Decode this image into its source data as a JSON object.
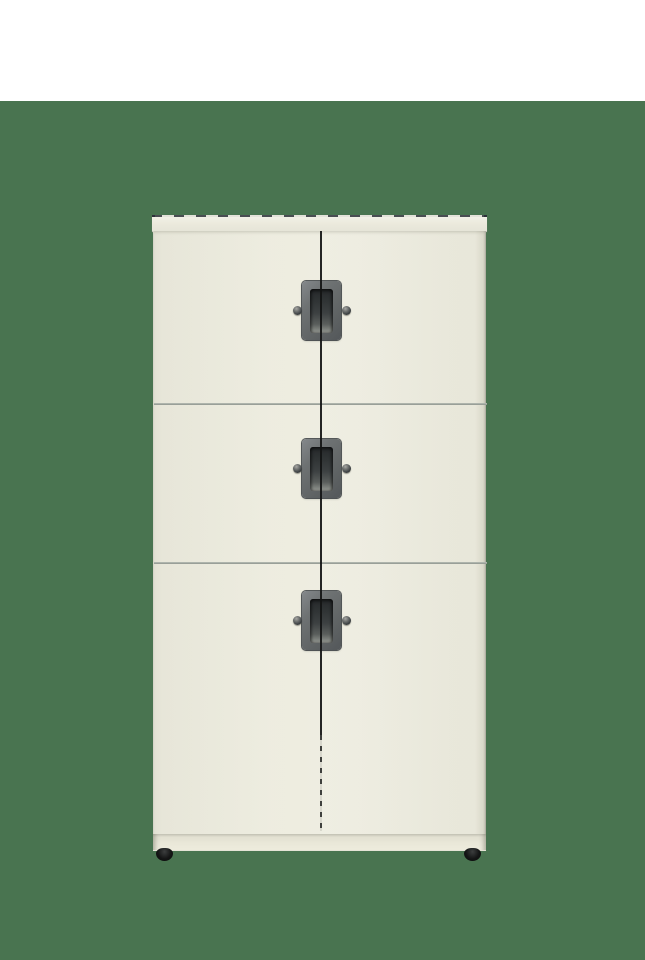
{
  "scene": {
    "type": "product-render",
    "object": "six-door locker storage cabinet, front view",
    "background_top": "#FFFFFF",
    "background": "#497450"
  },
  "theme": {
    "bg_white": "#FFFFFF",
    "bg_green": "#497450",
    "door_cream": "#EDECDF",
    "door_cream_dark": "#E7E6D8",
    "door_cream_light": "#EFEEE2",
    "top_edge_dark": "#2C3138",
    "edge_line": "#C6C6BB",
    "divider_gray": "#8F958E",
    "gap_dark": "#141616",
    "handle_frame": "#6E7273",
    "handle_frame_edge": "#3A3E42",
    "handle_recess_dark": "#26292B",
    "handle_recess_light": "#9A9D97",
    "lock_gray": "#3A3E40",
    "plinth_cream": "#E9E7D8",
    "plinth_shadow": "#C2C1B3",
    "foot_black": "#141515"
  },
  "cabinet": {
    "material_color": "#EDECDF",
    "rows": [
      {
        "id": "top",
        "label": "top compartment",
        "doors": 2,
        "handle": "recessed pull",
        "locks": 2
      },
      {
        "id": "middle",
        "label": "middle compartment",
        "doors": 2,
        "handle": "recessed pull",
        "locks": 2
      },
      {
        "id": "bottom",
        "label": "bottom compartment",
        "doors": 2,
        "handle": "recessed pull",
        "locks": 2
      }
    ],
    "feet": 2
  }
}
